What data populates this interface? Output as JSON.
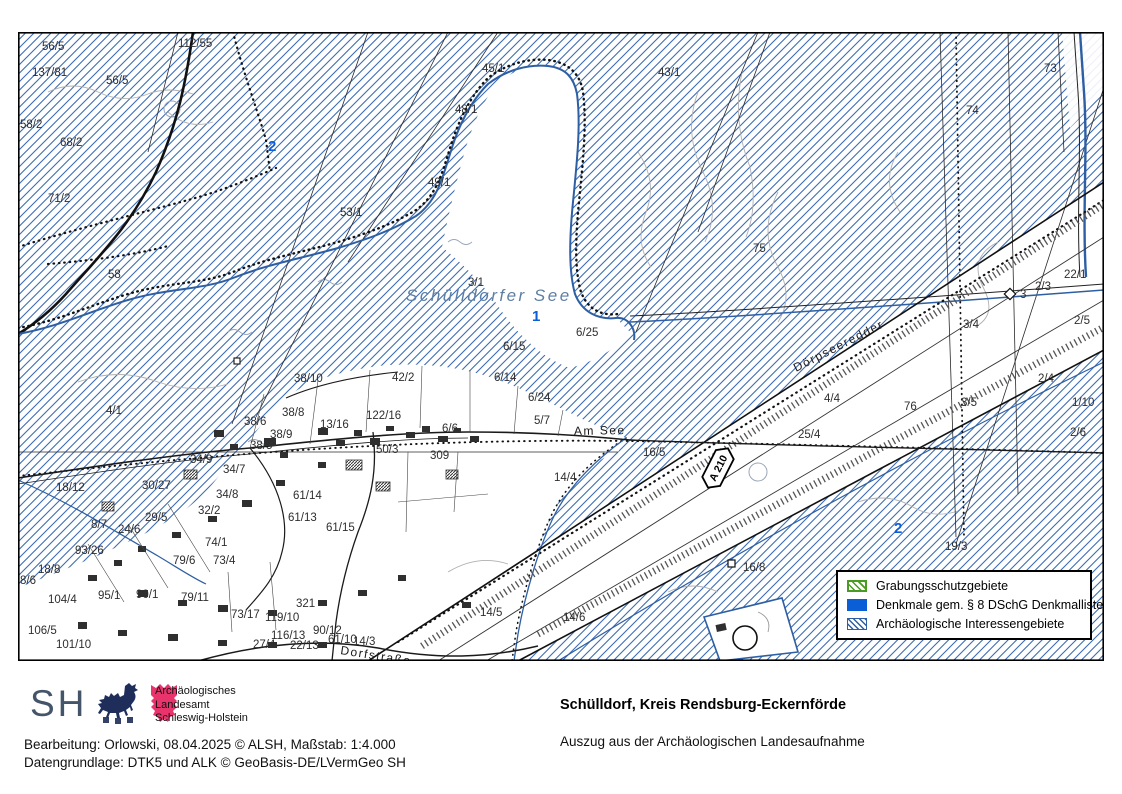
{
  "map": {
    "lake_name": "Schülldorfer See",
    "highway_shield": "A 210",
    "labels": [
      {
        "t": "56/5",
        "x": 24,
        "y": 18
      },
      {
        "t": "112/55",
        "x": 160,
        "y": 15
      },
      {
        "t": "137/81",
        "x": 14,
        "y": 44
      },
      {
        "t": "56/5",
        "x": 88,
        "y": 52
      },
      {
        "t": "58/2",
        "x": 2,
        "y": 96
      },
      {
        "t": "68/2",
        "x": 42,
        "y": 114
      },
      {
        "t": "71/2",
        "x": 30,
        "y": 170
      },
      {
        "t": "58",
        "x": 90,
        "y": 246
      },
      {
        "t": "45/1",
        "x": 464,
        "y": 40
      },
      {
        "t": "48/1",
        "x": 437,
        "y": 81
      },
      {
        "t": "43/1",
        "x": 640,
        "y": 44
      },
      {
        "t": "49/1",
        "x": 410,
        "y": 154
      },
      {
        "t": "53/1",
        "x": 322,
        "y": 184
      },
      {
        "t": "73",
        "x": 1026,
        "y": 40
      },
      {
        "t": "74",
        "x": 948,
        "y": 82
      },
      {
        "t": "75",
        "x": 735,
        "y": 220
      },
      {
        "t": "3/1",
        "x": 450,
        "y": 254
      },
      {
        "t": "6/25",
        "x": 558,
        "y": 304
      },
      {
        "t": "6/15",
        "x": 485,
        "y": 318
      },
      {
        "t": "2/3",
        "x": 1017,
        "y": 258
      },
      {
        "t": "3",
        "x": 1002,
        "y": 266
      },
      {
        "t": "3/4",
        "x": 945,
        "y": 296
      },
      {
        "t": "2/4",
        "x": 1020,
        "y": 350
      },
      {
        "t": "3/5",
        "x": 943,
        "y": 374
      },
      {
        "t": "22/1",
        "x": 1046,
        "y": 246
      },
      {
        "t": "2/5",
        "x": 1056,
        "y": 292
      },
      {
        "t": "1/10",
        "x": 1054,
        "y": 374
      },
      {
        "t": "2/6",
        "x": 1052,
        "y": 404
      },
      {
        "t": "4/4",
        "x": 806,
        "y": 370
      },
      {
        "t": "76",
        "x": 886,
        "y": 378
      },
      {
        "t": "25/4",
        "x": 780,
        "y": 406
      },
      {
        "t": "16/5",
        "x": 625,
        "y": 424
      },
      {
        "t": "14/4",
        "x": 536,
        "y": 449
      },
      {
        "t": "38/10",
        "x": 276,
        "y": 350
      },
      {
        "t": "42/2",
        "x": 374,
        "y": 349
      },
      {
        "t": "6/14",
        "x": 476,
        "y": 349
      },
      {
        "t": "4/1",
        "x": 88,
        "y": 382
      },
      {
        "t": "38/6",
        "x": 226,
        "y": 393
      },
      {
        "t": "38/8",
        "x": 264,
        "y": 384
      },
      {
        "t": "38/9",
        "x": 252,
        "y": 406
      },
      {
        "t": "38/5",
        "x": 232,
        "y": 417
      },
      {
        "t": "122/16",
        "x": 348,
        "y": 387
      },
      {
        "t": "13/16",
        "x": 302,
        "y": 396
      },
      {
        "t": "50/3",
        "x": 358,
        "y": 421
      },
      {
        "t": "309",
        "x": 412,
        "y": 427
      },
      {
        "t": "6/6",
        "x": 424,
        "y": 400
      },
      {
        "t": "6/24",
        "x": 510,
        "y": 369
      },
      {
        "t": "5/7",
        "x": 516,
        "y": 392
      },
      {
        "t": "18/12",
        "x": 38,
        "y": 459
      },
      {
        "t": "30/27",
        "x": 124,
        "y": 457
      },
      {
        "t": "34/9",
        "x": 172,
        "y": 431
      },
      {
        "t": "34/7",
        "x": 205,
        "y": 441
      },
      {
        "t": "34/8",
        "x": 198,
        "y": 466
      },
      {
        "t": "32/2",
        "x": 180,
        "y": 482
      },
      {
        "t": "29/5",
        "x": 127,
        "y": 489
      },
      {
        "t": "24/6",
        "x": 100,
        "y": 501
      },
      {
        "t": "8/7",
        "x": 73,
        "y": 496
      },
      {
        "t": "93/26",
        "x": 57,
        "y": 522
      },
      {
        "t": "61/14",
        "x": 275,
        "y": 467
      },
      {
        "t": "61/13",
        "x": 270,
        "y": 489
      },
      {
        "t": "61/15",
        "x": 308,
        "y": 499
      },
      {
        "t": "74/1",
        "x": 187,
        "y": 514
      },
      {
        "t": "73/4",
        "x": 195,
        "y": 532
      },
      {
        "t": "79/6",
        "x": 155,
        "y": 532
      },
      {
        "t": "95/1",
        "x": 80,
        "y": 567
      },
      {
        "t": "90/1",
        "x": 118,
        "y": 566
      },
      {
        "t": "79/11",
        "x": 163,
        "y": 569
      },
      {
        "t": "73/17",
        "x": 213,
        "y": 586
      },
      {
        "t": "119/10",
        "x": 247,
        "y": 589
      },
      {
        "t": "321",
        "x": 278,
        "y": 575
      },
      {
        "t": "116/13",
        "x": 253,
        "y": 607
      },
      {
        "t": "61/10",
        "x": 310,
        "y": 611
      },
      {
        "t": "14/3",
        "x": 335,
        "y": 613
      },
      {
        "t": "27/4",
        "x": 235,
        "y": 616
      },
      {
        "t": "22/13",
        "x": 272,
        "y": 617
      },
      {
        "t": "90/12",
        "x": 295,
        "y": 602
      },
      {
        "t": "104/4",
        "x": 30,
        "y": 571
      },
      {
        "t": "106/5",
        "x": 10,
        "y": 602
      },
      {
        "t": "101/10",
        "x": 38,
        "y": 616
      },
      {
        "t": "18/8",
        "x": 20,
        "y": 541
      },
      {
        "t": "8/6",
        "x": 2,
        "y": 552
      },
      {
        "t": "19/3",
        "x": 927,
        "y": 518
      },
      {
        "t": "16/8",
        "x": 725,
        "y": 539
      },
      {
        "t": "14/6",
        "x": 545,
        "y": 589
      },
      {
        "t": "14/5",
        "x": 462,
        "y": 584
      },
      {
        "t": "Am See",
        "x": 556,
        "y": 403,
        "r": -1,
        "c": "street"
      },
      {
        "t": "Dörpseeredder",
        "x": 778,
        "y": 340,
        "r": -27,
        "c": "street"
      },
      {
        "t": "Dorfstraße",
        "x": 322,
        "y": 622,
        "r": 9,
        "c": "street"
      },
      {
        "t": "Schülldorfer See",
        "x": 388,
        "y": 269,
        "c": "lake"
      }
    ],
    "markers": [
      {
        "t": "2",
        "x": 250,
        "y": 119
      },
      {
        "t": "1",
        "x": 514,
        "y": 289
      },
      {
        "t": "2",
        "x": 876,
        "y": 501
      }
    ]
  },
  "legend": {
    "items": [
      {
        "label": "Grabungsschutzgebiete",
        "swatch": "green-hatch"
      },
      {
        "label": "Denkmale gem. § 8 DSchG Denkmalliste",
        "swatch": "blue-solid"
      },
      {
        "label": "Archäologische Interessengebiete",
        "swatch": "blue-hatch"
      }
    ]
  },
  "footer": {
    "logo_text": "SH",
    "agency_line1": "Archäologisches",
    "agency_line2": "Landesamt",
    "agency_line3": "Schleswig-Holstein",
    "title": "Schülldorf, Kreis Rendsburg-Eckernförde",
    "subtitle": "Auszug aus der Archäologischen Landesaufnahme",
    "credit_line1": "Bearbeitung: Orlowski, 08.04.2025 © ALSH, Maßstab: 1:4.000",
    "credit_line2": "Datengrundlage: DTK5 und ALK © GeoBasis-DE/LVermGeo SH"
  },
  "colors": {
    "interest_hatch_blue": "#3e6db4",
    "marker_blue": "#0a5fd6",
    "legend_green": "#4a9b21",
    "denkmal_blue": "#0a5fd6",
    "lake_label": "#5d7fa4"
  }
}
